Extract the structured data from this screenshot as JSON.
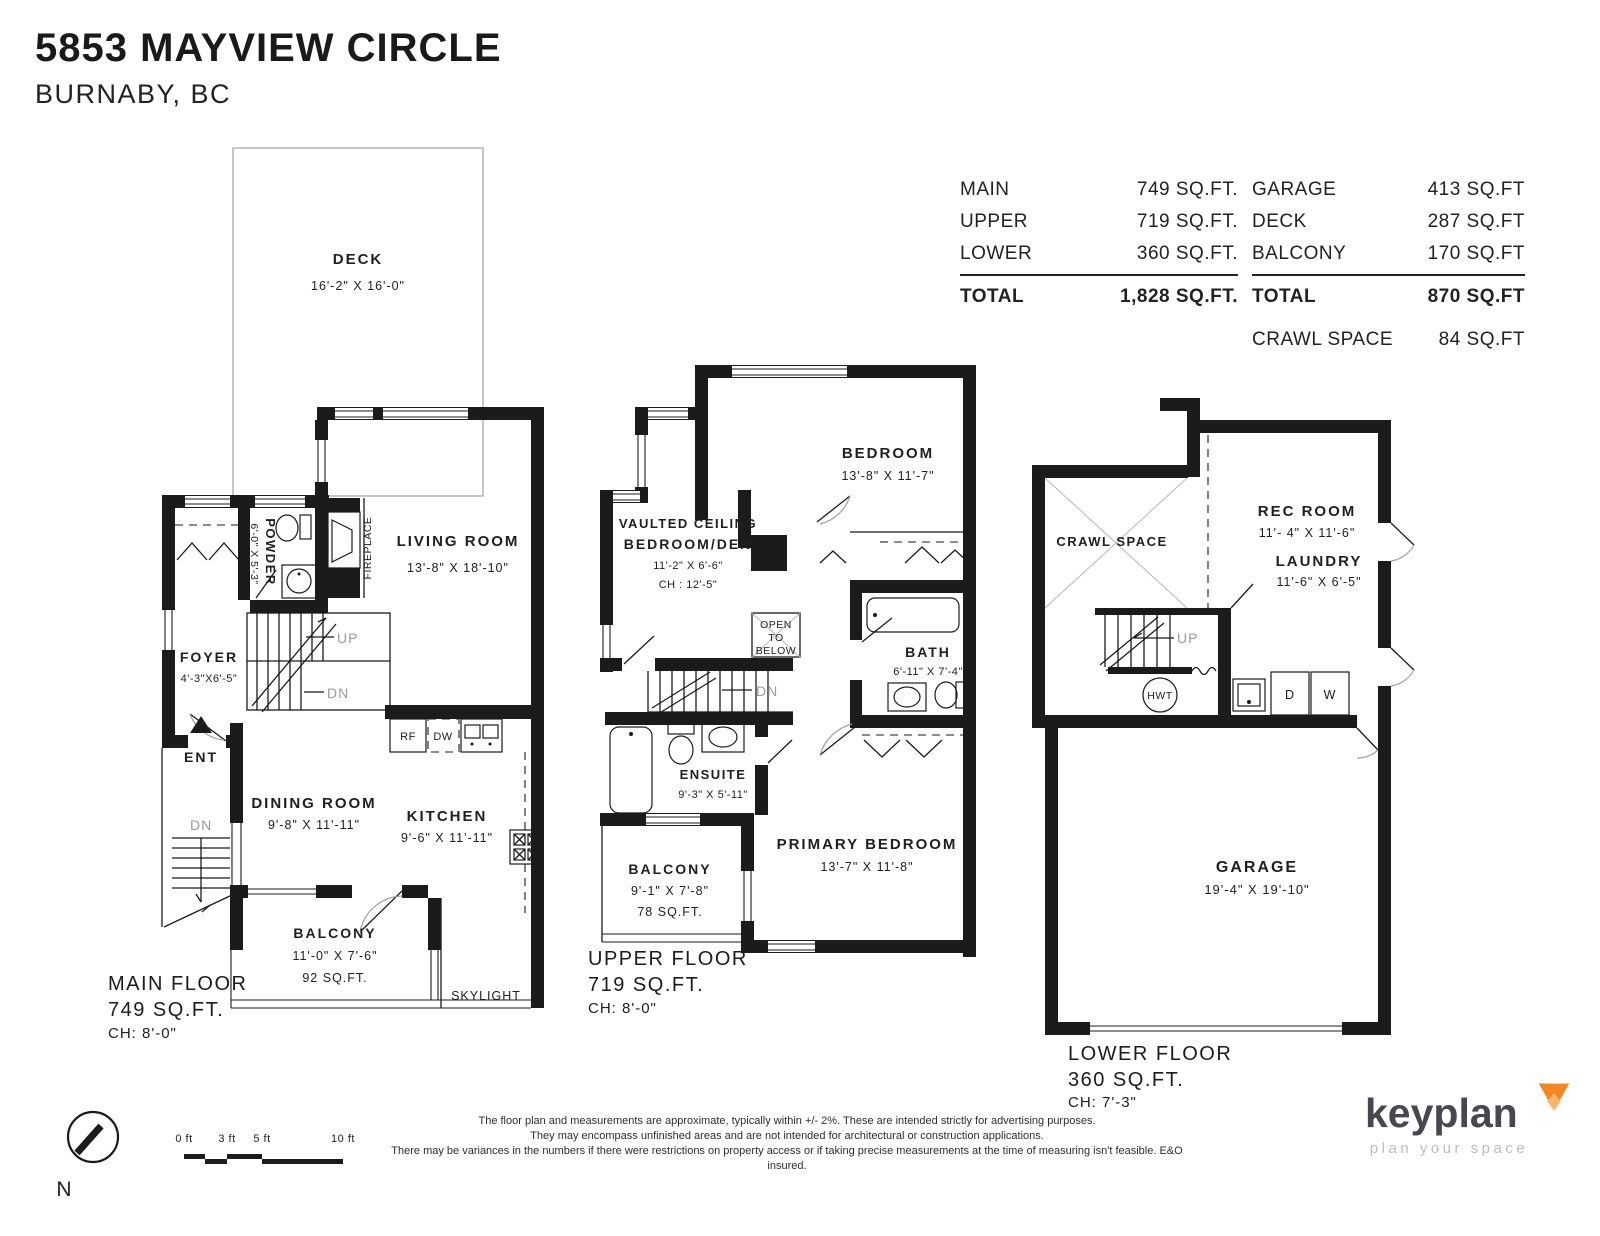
{
  "header": {
    "address": "5853 MAYVIEW CIRCLE",
    "city": "BURNABY, BC"
  },
  "area_table": {
    "left": {
      "rows": [
        {
          "label": "MAIN",
          "value": "749 SQ.FT."
        },
        {
          "label": "UPPER",
          "value": "719 SQ.FT."
        },
        {
          "label": "LOWER",
          "value": "360 SQ.FT."
        }
      ],
      "total_label": "TOTAL",
      "total_value": "1,828 SQ.FT."
    },
    "right": {
      "rows": [
        {
          "label": "GARAGE",
          "value": "413 SQ.FT"
        },
        {
          "label": "DECK",
          "value": "287 SQ.FT"
        },
        {
          "label": "BALCONY",
          "value": "170 SQ.FT"
        }
      ],
      "total_label": "TOTAL",
      "total_value": "870 SQ.FT",
      "extra_label": "CRAWL SPACE",
      "extra_value": "84 SQ.FT"
    }
  },
  "main_floor": {
    "deck": {
      "label": "DECK",
      "dims": "16'-2\" X 16'-0\""
    },
    "living": {
      "label": "LIVING ROOM",
      "dims": "13'-8\" X 18'-10\""
    },
    "powder": {
      "label": "POWDER",
      "dims": "6'-0\" X 5'-3\""
    },
    "fireplace_label": "FIREPLACE",
    "foyer": {
      "label": "FOYER",
      "dims": "4'-3\"X6'-5\""
    },
    "dining": {
      "label": "DINING ROOM",
      "dims": "9'-8\" X 11'-11\""
    },
    "kitchen": {
      "label": "KITCHEN",
      "dims": "9'-6\" X 11'-11\""
    },
    "balcony": {
      "label": "BALCONY",
      "dims": "11'-0\" X 7'-6\"",
      "area": "92 SQ.FT."
    },
    "skylight_label": "SKYLIGHT",
    "rf": "RF",
    "dw": "DW",
    "up": "UP",
    "dn_stairs": "DN",
    "dn_entry": "DN",
    "ent": "ENT",
    "floor_label": {
      "name": "MAIN FLOOR",
      "area": "749 SQ.FT.",
      "ch": "CH: 8'-0\""
    }
  },
  "upper_floor": {
    "bedroom": {
      "label": "BEDROOM",
      "dims": "13'-8\" X 11'-7\""
    },
    "den": {
      "line1": "VAULTED CEILING",
      "line2": "BEDROOM/DEN",
      "dims": "11'-2\" X 6'-6\"",
      "ch": "CH : 12'-5\""
    },
    "open_below": {
      "l1": "OPEN",
      "l2": "TO",
      "l3": "BELOW"
    },
    "bath": {
      "label": "BATH",
      "dims": "6'-11\" X 7'-4\""
    },
    "ensuite": {
      "label": "ENSUITE",
      "dims": "9'-3\" X 5'-11\""
    },
    "primary": {
      "label": "PRIMARY BEDROOM",
      "dims": "13'-7\" X 11'-8\""
    },
    "balcony": {
      "label": "BALCONY",
      "dims": "9'-1\" X 7'-8\"",
      "area": "78 SQ.FT."
    },
    "dn": "DN",
    "floor_label": {
      "name": "UPPER FLOOR",
      "area": "719 SQ.FT.",
      "ch": "CH: 8'-0\""
    }
  },
  "lower_floor": {
    "crawl_label": "CRAWL SPACE",
    "rec": {
      "label": "REC ROOM",
      "dims": "11'- 4\" X 11'-6\""
    },
    "laundry": {
      "label": "LAUNDRY",
      "dims": "11'-6\" X 6'-5\""
    },
    "garage": {
      "label": "GARAGE",
      "dims": "19'-4\" X 19'-10\""
    },
    "up": "UP",
    "hwt": "HWT",
    "d": "D",
    "w": "W",
    "floor_label": {
      "name": "LOWER FLOOR",
      "area": "360 SQ.FT.",
      "ch": "CH: 7'-3\""
    }
  },
  "footer": {
    "north_label": "N",
    "scale": {
      "t0": "0 ft",
      "t3": "3 ft",
      "t5": "5 ft",
      "t10": "10 ft"
    },
    "disclaimer": {
      "line1": "The floor plan and measurements are approximate, typically within +/- 2%. These are intended strictly for advertising purposes.",
      "line2": "They may encompass unfinished areas and are not intended for architectural or construction applications.",
      "line3": "There may be variances in the numbers if there were restrictions on property access or if taking precise measurements at the time of measuring isn't feasible. E&O insured."
    },
    "logo": {
      "brand": "keyplan",
      "tagline": "plan your space"
    }
  }
}
